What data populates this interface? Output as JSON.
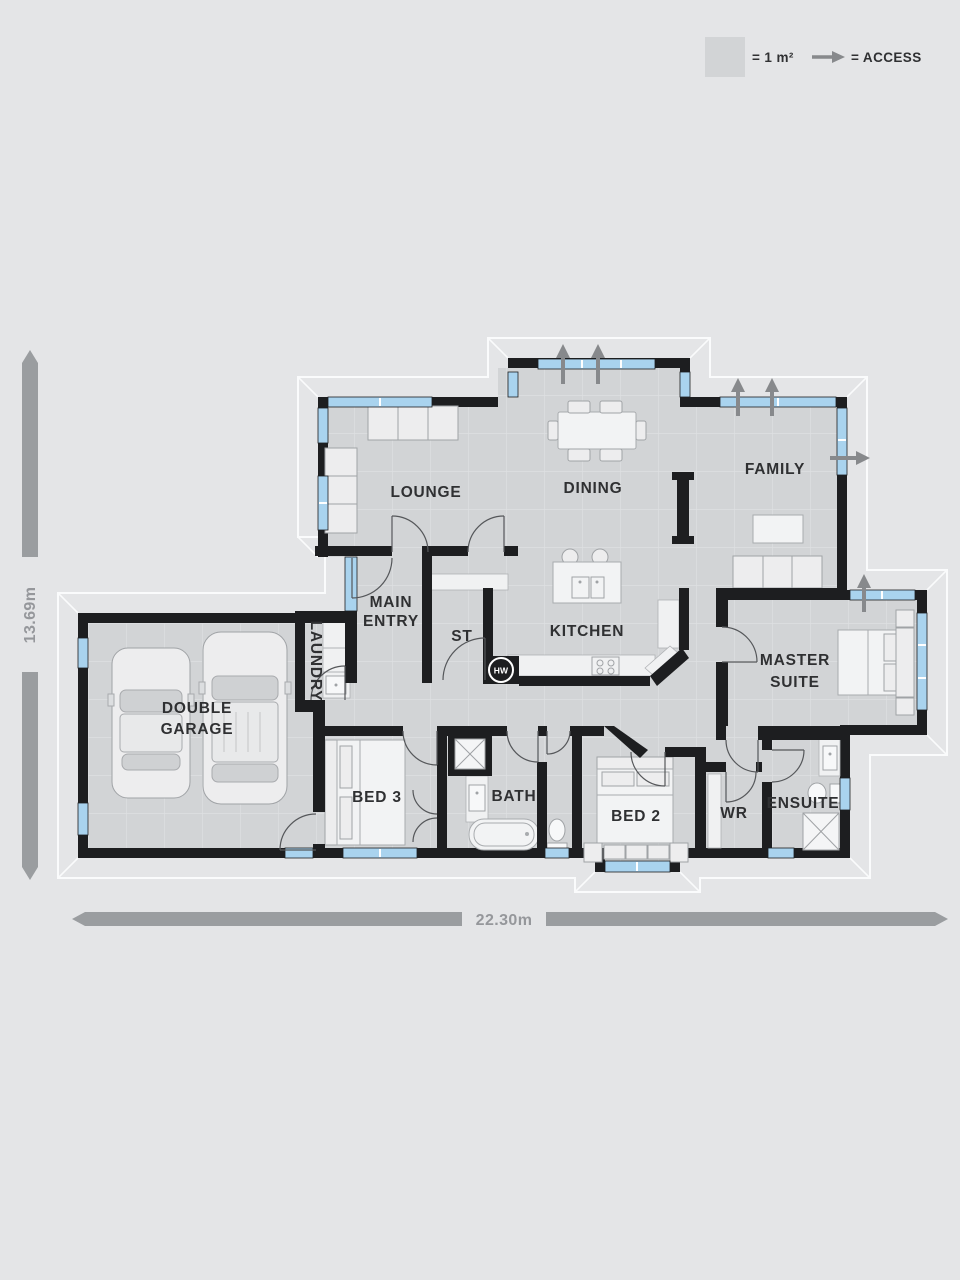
{
  "legend": {
    "area_square_label": "= 1 m²",
    "access_label": "= ACCESS"
  },
  "dimensions": {
    "width_label": "22.30m",
    "height_label": "13.69m"
  },
  "rooms": {
    "lounge": "LOUNGE",
    "dining": "DINING",
    "family": "FAMILY",
    "main_entry_line1": "MAIN",
    "main_entry_line2": "ENTRY",
    "storage": "ST",
    "kitchen": "KITCHEN",
    "master_line1": "MASTER",
    "master_line2": "SUITE",
    "laundry": "LAUNDRY",
    "garage_line1": "DOUBLE",
    "garage_line2": "GARAGE",
    "bed3": "BED 3",
    "bath": "BATH",
    "bed2": "BED 2",
    "wardrobe": "WR",
    "ensuite": "ENSUITE"
  },
  "badges": {
    "hot_water": "HW"
  },
  "colors": {
    "background": "#e4e5e7",
    "floor": "#d2d4d6",
    "wall": "#1d1e20",
    "window": "#a9d3ee",
    "access_arrow": "#87898c",
    "dimension_bar": "#9a9da0",
    "label_text": "#2f3032",
    "eave_outline": "#fafbfc"
  }
}
